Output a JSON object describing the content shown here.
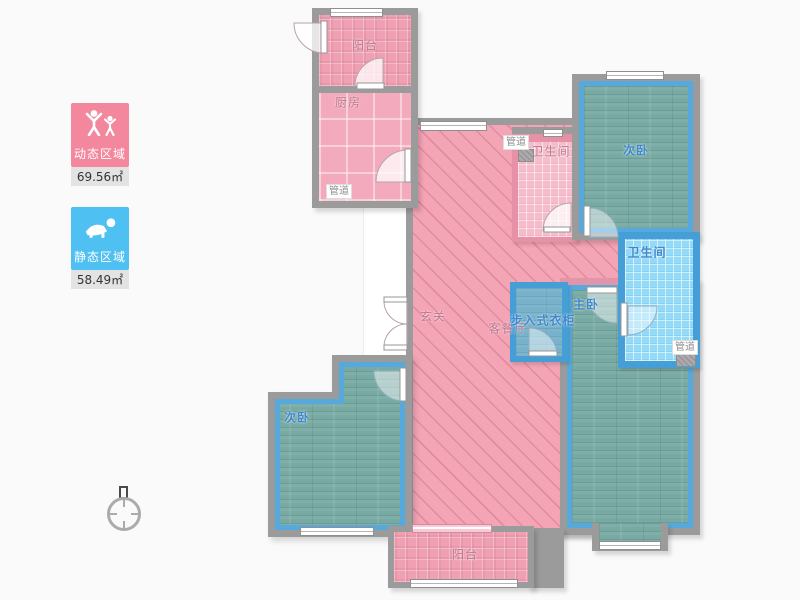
{
  "legend": {
    "dynamic": {
      "label": "动态区域",
      "area": "69.56㎡",
      "color": "#F2879E"
    },
    "static": {
      "label": "静态区域",
      "area": "58.49㎡",
      "color": "#4FC0F2"
    }
  },
  "rooms": {
    "balcony_top": "阳台",
    "kitchen": "厨房",
    "bathroom_pink": "卫生间",
    "bedroom_top_right": "次卧",
    "bathroom_blue": "卫生间",
    "entry": "玄关",
    "living_dining": "客餐厅",
    "walk_in_closet": "步入式衣柜",
    "master_bedroom": "主卧",
    "bedroom_bottom_left": "次卧",
    "balcony_bottom": "阳台",
    "duct": "管道"
  },
  "colors": {
    "wall_gray": "#9B9B9B",
    "blue_wall": "#459FD6",
    "pink_floor": "#F3A4B5",
    "wood_floor": "#78AAA4",
    "bath_blue_floor": "#92DAF8",
    "label_pink": "#C0758C",
    "label_blue": "#3F88CC"
  }
}
